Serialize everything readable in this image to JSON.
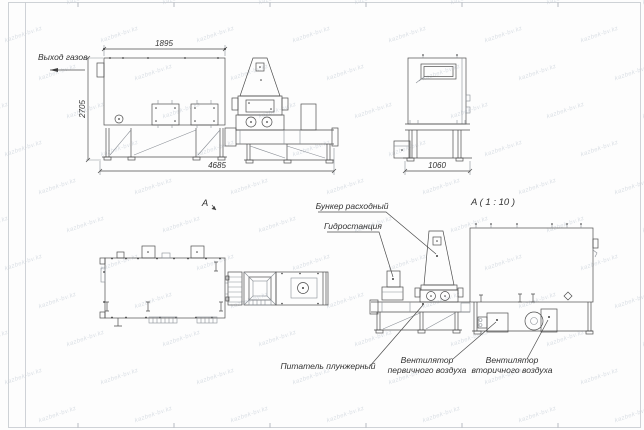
{
  "sheet": {
    "watermark_text": "kazbek-bv.kz"
  },
  "side_view": {
    "gas_outlet_label": "Выход газов",
    "dim_width": "1895",
    "dim_height": "2705",
    "dim_length": "4685"
  },
  "end_view": {
    "dim_width": "1060"
  },
  "plan_view": {
    "view_label": "A"
  },
  "detail_view": {
    "title": "A ( 1 : 10 )",
    "hopper_label": "Бункер расходный",
    "hydrostation_label": "Гидростанция",
    "feeder_label": "Питатель плунжерный",
    "primary_fan_label_line1": "Вентилятор",
    "primary_fan_label_line2": "первичного воздуха",
    "secondary_fan_label_line1": "Вентилятор",
    "secondary_fan_label_line2": "вторичного воздуха"
  },
  "colors": {
    "line": "#4d4d4d",
    "text": "#333333",
    "watermark": "#8c9baf"
  }
}
